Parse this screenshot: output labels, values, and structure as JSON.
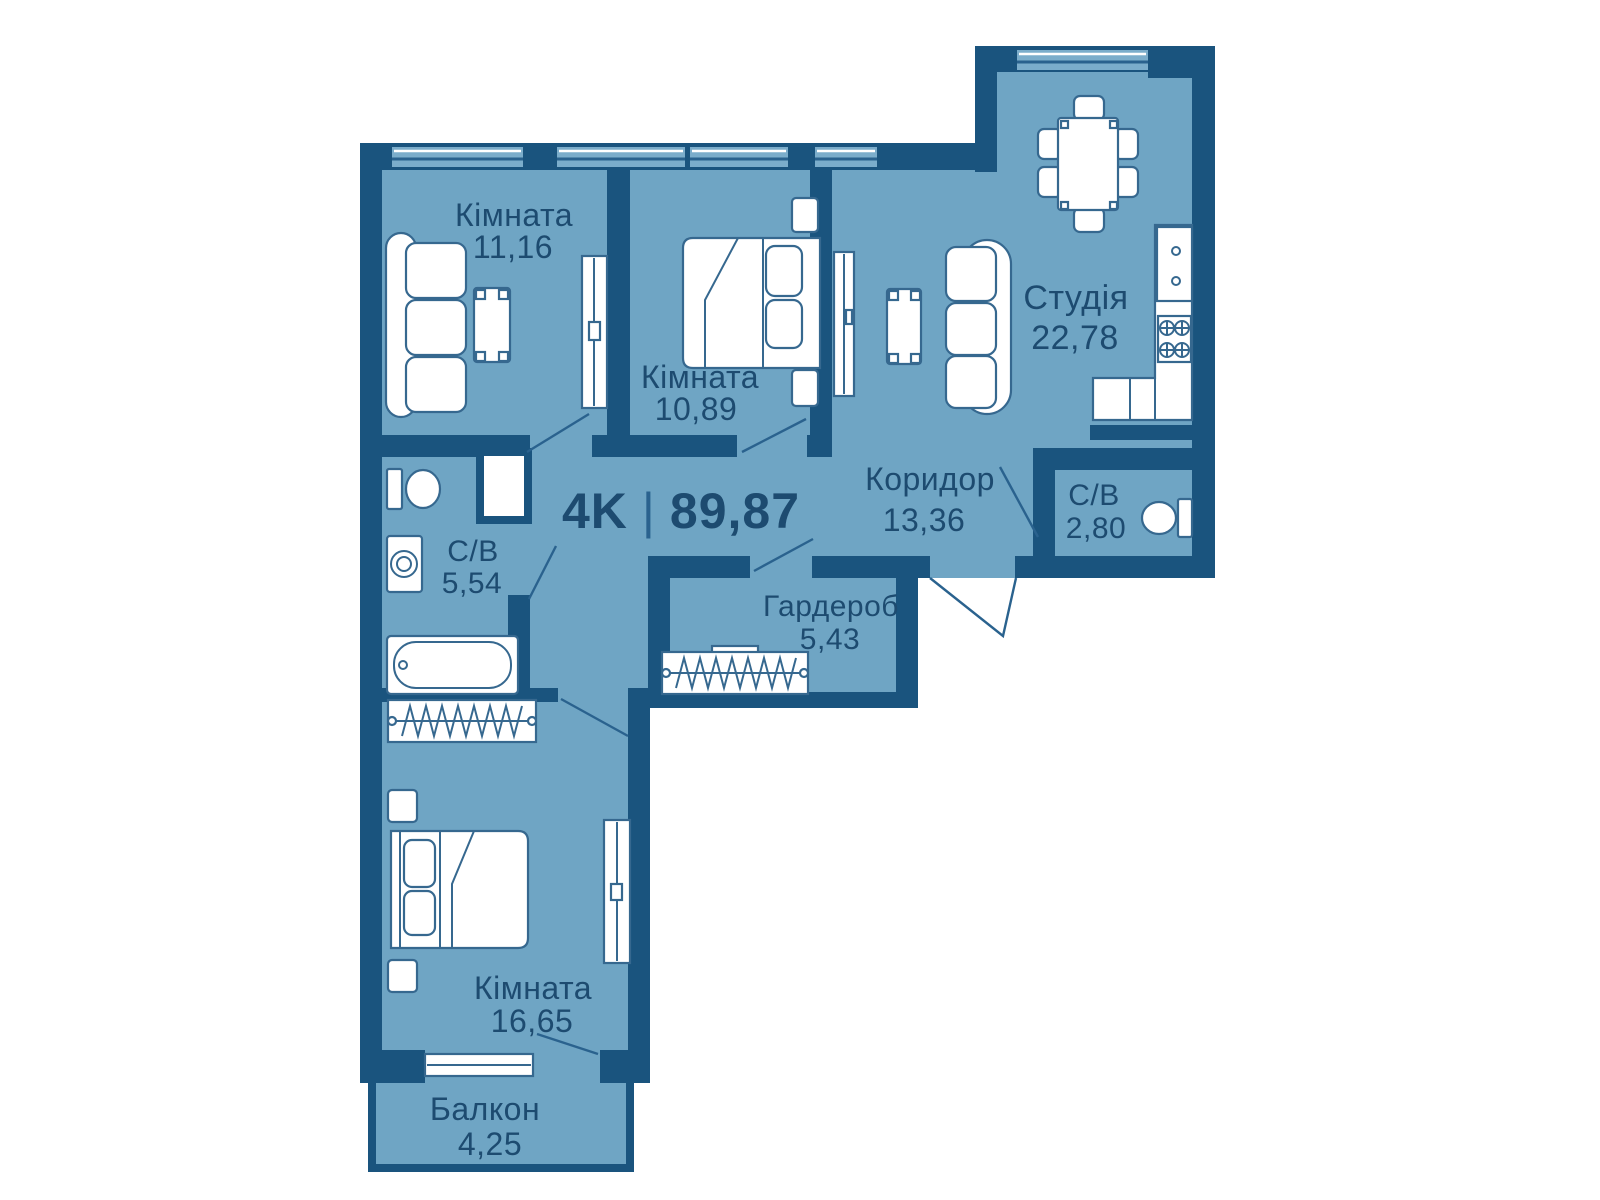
{
  "plan": {
    "title": {
      "type": "4K",
      "separator": "|",
      "area": "89,87"
    },
    "rooms": [
      {
        "id": "room-1",
        "name": "Кімната",
        "area": "11,16"
      },
      {
        "id": "room-2",
        "name": "Кімната",
        "area": "10,89"
      },
      {
        "id": "studio",
        "name": "Студія",
        "area": "22,78"
      },
      {
        "id": "corridor",
        "name": "Коридор",
        "area": "13,36"
      },
      {
        "id": "bathroom-small",
        "name": "С/В",
        "area": "2,80"
      },
      {
        "id": "bathroom-large",
        "name": "С/В",
        "area": "5,54"
      },
      {
        "id": "wardrobe-room",
        "name": "Гардероб",
        "area": "5,43"
      },
      {
        "id": "room-3",
        "name": "Кімната",
        "area": "16,65"
      },
      {
        "id": "balcony",
        "name": "Балкон",
        "area": "4,25"
      }
    ],
    "colors": {
      "wall": "#1a547e",
      "floor": "#6fa5c4",
      "window": "#7badcb",
      "text": "#1d4b70",
      "furniture_outline": "#36688f"
    }
  }
}
